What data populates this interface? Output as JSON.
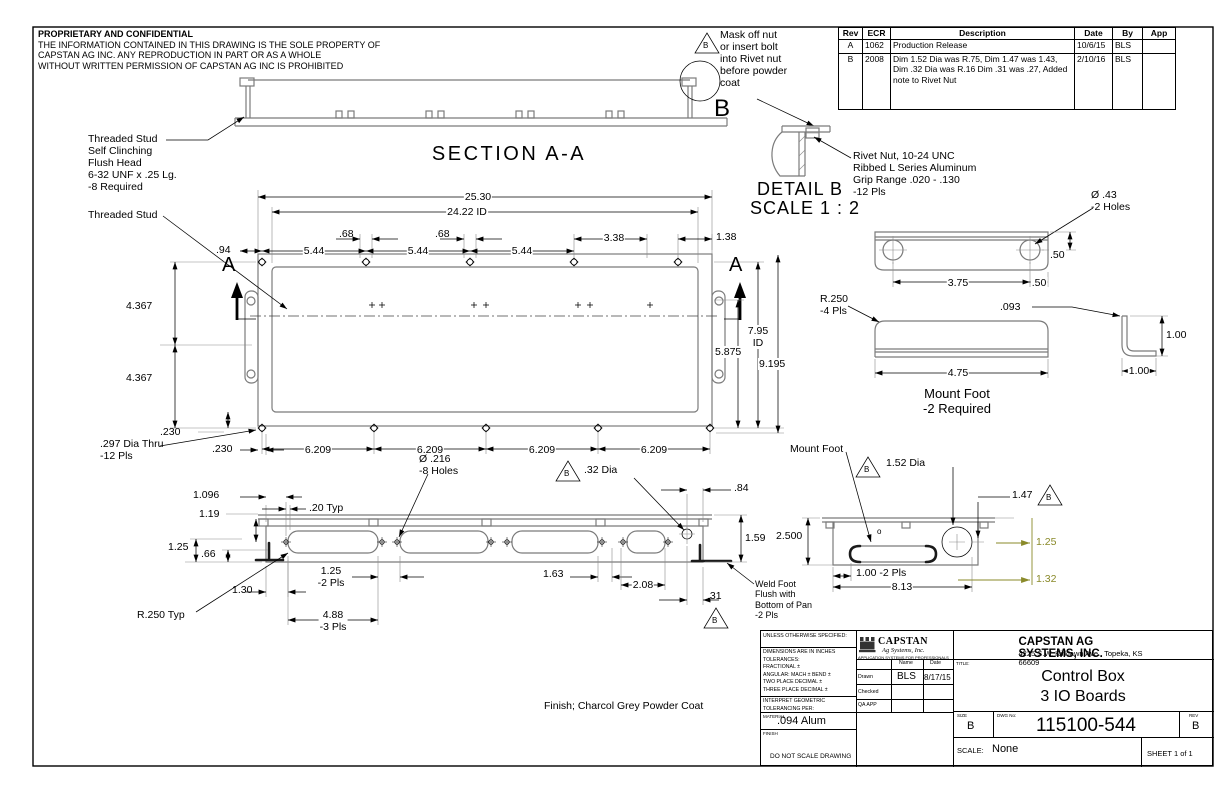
{
  "colors": {
    "part_line": "#7b7b7b",
    "dim_line": "#000000",
    "highlight_dim": "#8a8a2a"
  },
  "notice": {
    "title": "PROPRIETARY AND CONFIDENTIAL",
    "body": "THE INFORMATION CONTAINED IN THIS DRAWING IS THE SOLE PROPERTY OF\nCAPSTAN AG INC. ANY REPRODUCTION IN PART OR AS A WHOLE\nWITHOUT WRITTEN PERMISSION OF CAPSTAN AG INC IS PROHIBITED"
  },
  "rev_table": {
    "headers": [
      "Rev",
      "ECR",
      "Description",
      "Date",
      "By",
      "App"
    ],
    "rows": [
      {
        "rev": "A",
        "ecr": "1062",
        "desc": "Production Release",
        "date": "10/6/15",
        "by": "BLS",
        "app": ""
      },
      {
        "rev": "B",
        "ecr": "2008",
        "desc": "Dim 1.52 Dia was R.75, Dim 1.47 was 1.43, Dim .32 Dia was R.16 Dim .31 was .27, Added note to Rivet Nut",
        "date": "2/10/16",
        "by": "BLS",
        "app": ""
      }
    ]
  },
  "section": {
    "title": "SECTION A-A",
    "detail_letter": "B",
    "cut_letter": "A",
    "stud_note": "Threaded Stud\nSelf Clinching\nFlush Head\n6-32 UNF x .25 Lg.\n-8 Required",
    "mask_note": "Mask off nut\nor insert bolt\ninto Rivet nut\nbefore powder\ncoat",
    "mask_flag": "B"
  },
  "detail_b": {
    "title": "DETAIL B",
    "scale": "SCALE 1 : 2",
    "rivet_note": "Rivet Nut, 10-24 UNC\nRibbed L Series Aluminum\nGrip Range .020 - .130\n-12 Pls"
  },
  "front": {
    "stud_label": "Threaded Stud",
    "hole_note": ".297 Dia Thru\n-12 Pls",
    "dims": {
      "overall": "25.30",
      "inner": "24.22 ID",
      "g1": ".68",
      "g2": ".68",
      "off": ".94",
      "p1": "5.44",
      "p2": "5.44",
      "p3": "5.44",
      "d338": "3.38",
      "d138": "1.38",
      "h1": "4.367",
      "h2": "4.367",
      "t1": ".230",
      "t2": ".230",
      "id_h": "7.95\nID",
      "d5875": "5.875",
      "d9195": "9.195",
      "b1": "6.209",
      "b2": "6.209",
      "b3": "6.209",
      "b4": "6.209"
    }
  },
  "mount_foot": {
    "hole_note": "Ø .43\n-2 Holes",
    "r_note": "R.250\n-4 Pls",
    "label": "Mount Foot\n-2 Required",
    "dims": {
      "d50a": ".50",
      "d375": "3.75",
      "d50b": ".50",
      "d093": ".093",
      "d475": "4.75",
      "leg_v": "1.00",
      "leg_h": "1.00"
    }
  },
  "bottom": {
    "hole_note": "Ø .216\n-8 Holes",
    "r_note": "R.250 Typ",
    "flag1": "B",
    "d32": ".32 Dia",
    "weld_note": "Weld Foot\nFlush with\nBottom of Pan\n-2 Pls",
    "flag2": "B",
    "dims": {
      "d1096": "1.096",
      "d119": "1.19",
      "d20": ".20 Typ",
      "d125": "1.25",
      "d66": ".66",
      "d130": "1.30",
      "d125b": "1.25\n-2 Pls",
      "d488": "4.88\n-3 Pls",
      "d163": "1.63",
      "d208": "2.08",
      "d31": ".31",
      "d84": ".84",
      "d159": "1.59"
    }
  },
  "side": {
    "label": "Mount Foot",
    "flag1": "B",
    "d152": "1.52 Dia",
    "flag2": "B",
    "d147": "1.47",
    "small_o": "o",
    "dims": {
      "d2500": "2.500",
      "d100": "1.00 -2 Pls",
      "d813": "8.13",
      "d125": "1.25",
      "d132": "1.32"
    }
  },
  "finish_note": "Finish; Charcol Grey Powder Coat",
  "title_block": {
    "unless": "UNLESS OTHERWISE SPECIFIED:",
    "tolerances": "DIMENSIONS ARE IN INCHES\nTOLERANCES:\nFRACTIONAL ±\nANGULAR: MACH ±   BEND ±\nTWO PLACE DECIMAL    ±\nTHREE PLACE DECIMAL  ±",
    "interpret": "INTERPRET GEOMETRIC\nTOLERANCING PER:",
    "material_label": "MATERIAL",
    "material_value": ".094 Alum",
    "finish_label": "FINISH",
    "do_not_scale": "DO NOT SCALE DRAWING",
    "logo_name": "CAPSTAN",
    "logo_sub": "Ag Systems, Inc.",
    "logo_tagline": "APPLICATION SYSTEMS FOR PROFESSIONALS",
    "name_col": "Name",
    "date_col": "Date",
    "drawn_label": "Drawn",
    "drawn_name": "BLS",
    "drawn_date": "8/17/15",
    "checked_label": "Checked",
    "qa_label": "QA APP",
    "company": "CAPSTAN AG SYSTEMS, INC.",
    "address": "4225 S.W. Kirklawn Ave., Topeka, KS 66609",
    "title_label": "TITLE:",
    "title_line1": "Control Box",
    "title_line2": "3 IO Boards",
    "size_label": "SIZE",
    "size_value": "B",
    "dwg_label": "DWG No:",
    "dwg_no": "115100-544",
    "rev_label": "REV",
    "rev_value": "B",
    "scale_label": "SCALE:",
    "scale_value": "None",
    "sheet_label": "SHEET 1 of 1"
  }
}
